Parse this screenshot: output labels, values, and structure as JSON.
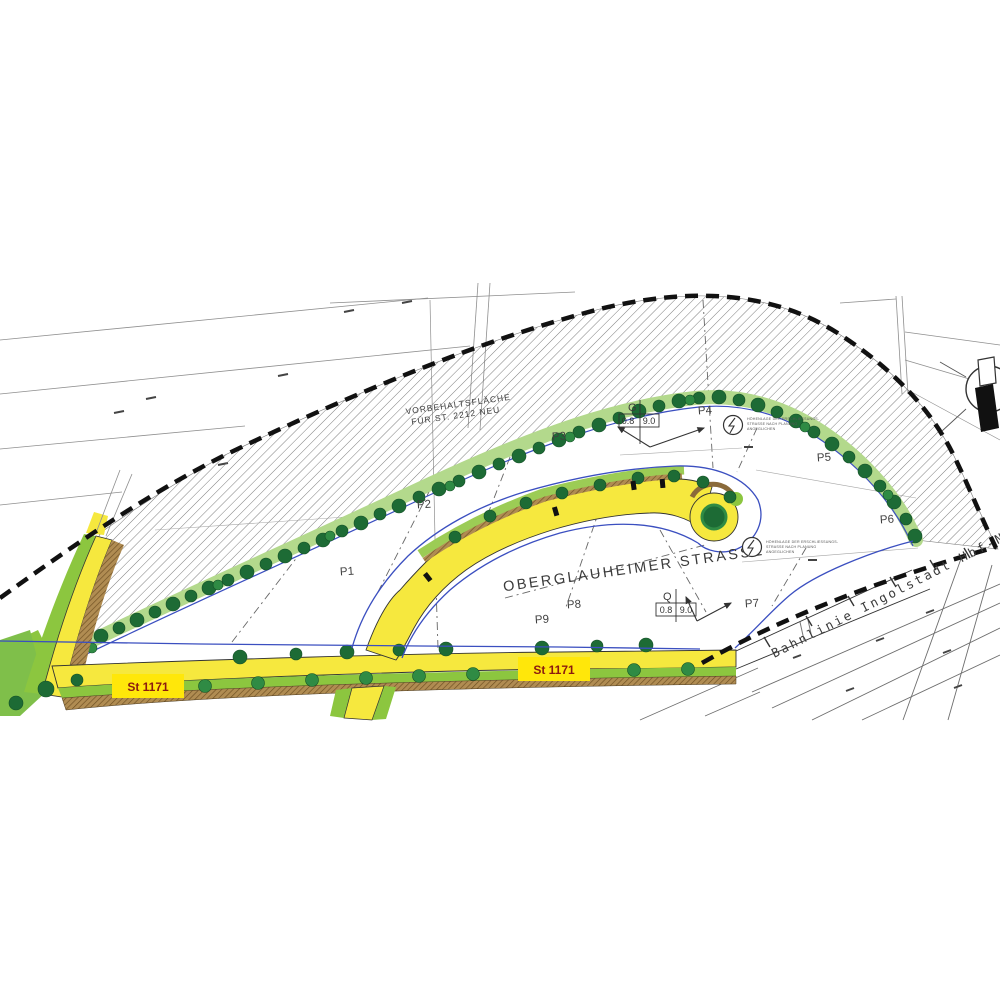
{
  "palette": {
    "road_yellow": "#f6e83e",
    "badge_yellow": "#ffe70a",
    "badge_text_red": "#8b1a10",
    "tree_dark_green": "#1d6b35",
    "tree_mid_green": "#2f8b44",
    "band_light_green": "#b3d98c",
    "verge_green": "#8cc63f",
    "boundary_blue": "#3b4fc0",
    "sidewalk_brown": "#9b7b45",
    "hatch_gray": "#6f6f6f",
    "line_black": "#1a1a1a"
  },
  "plan": {
    "reserved": {
      "line1": "VORBEHALTSFLÄCHE",
      "line2": "FÜR ST. 2212 NEU"
    },
    "street_label": "OBERGLAUHEIMER STRASSE",
    "railway_label": "Bahnlinie Ingolstadt Hbf-Ne",
    "badges": [
      {
        "text": "St 1171"
      },
      {
        "text": "St 1171"
      }
    ],
    "parcels": [
      "P1",
      "P2",
      "P3",
      "P4",
      "P5",
      "P6",
      "P7",
      "P8",
      "P9"
    ],
    "zoning_top": {
      "letter": "G",
      "grz": "0.8",
      "height": "9.0"
    },
    "zoning_bottom": {
      "letter": "Q",
      "grz": "0.8",
      "height": "9.0"
    },
    "notes": [
      {
        "lines": [
          "HÖHENLAGE DER ERSCHLIESSUNGS-",
          "STRASSE NACH PLANUNG",
          "ANGEGLICHEN"
        ]
      },
      {
        "lines": [
          "HÖHENLAGE DER ERSCHLIESSUNGS-",
          "STRASSE NACH PLANUNG",
          "ANGEGLICHEN"
        ]
      }
    ]
  }
}
